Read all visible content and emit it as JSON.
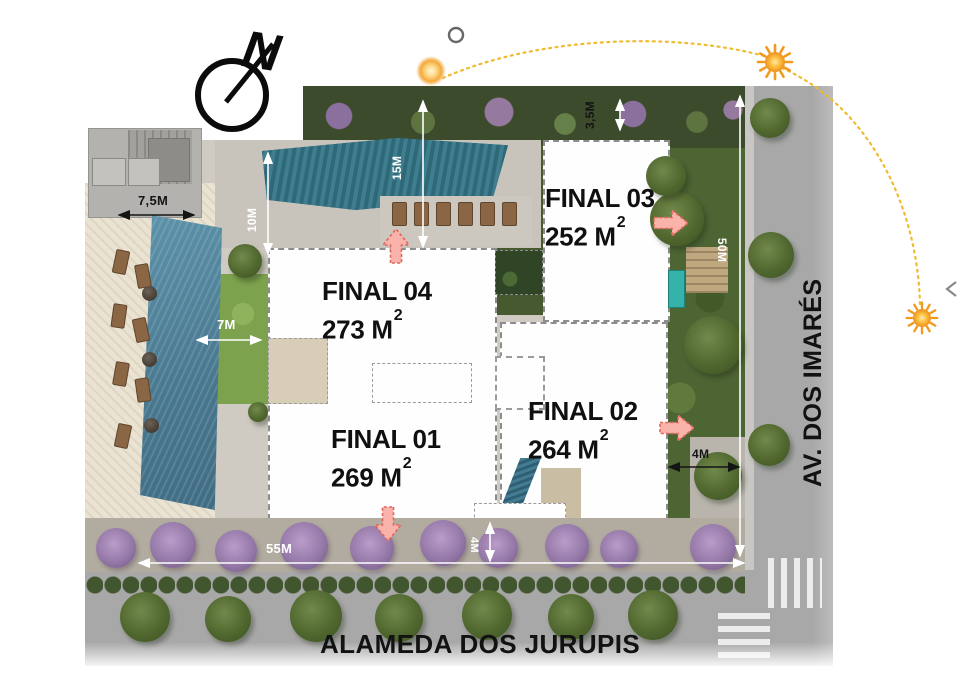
{
  "compass": {
    "label": "N"
  },
  "streets": {
    "bottom": "ALAMEDA DOS JURUPIS",
    "right": "AV. DOS IMARÉS"
  },
  "units": [
    {
      "name": "FINAL 01",
      "area": "269 M",
      "sup": "2"
    },
    {
      "name": "FINAL 02",
      "area": "264 M",
      "sup": "2"
    },
    {
      "name": "FINAL 03",
      "area": "252 M",
      "sup": "2"
    },
    {
      "name": "FINAL 04",
      "area": "273 M",
      "sup": "2"
    }
  ],
  "dims": {
    "pool_width": "7,5M",
    "path_10": "10M",
    "garden_15": "15M",
    "strip_35": "3,5M",
    "lawn_7": "7M",
    "side_50": "50M",
    "garden_4": "4M",
    "front_55": "55M",
    "sidewalk_4": "4M"
  },
  "icons": {
    "compass": "north-arrow",
    "sun_markers": "sun-path",
    "entrances": "entrance-arrow"
  },
  "colors": {
    "entrance_arrow": "#f9b3ab",
    "entrance_arrow_stroke": "#de675c",
    "sun": "#f6a623",
    "sun_path": "#eebc2e",
    "building_fill": "#fefefe",
    "pool": "#58869e",
    "lawn": "#7da24d",
    "road": "#a8a8a8",
    "flower_tree": "#9579a8"
  }
}
